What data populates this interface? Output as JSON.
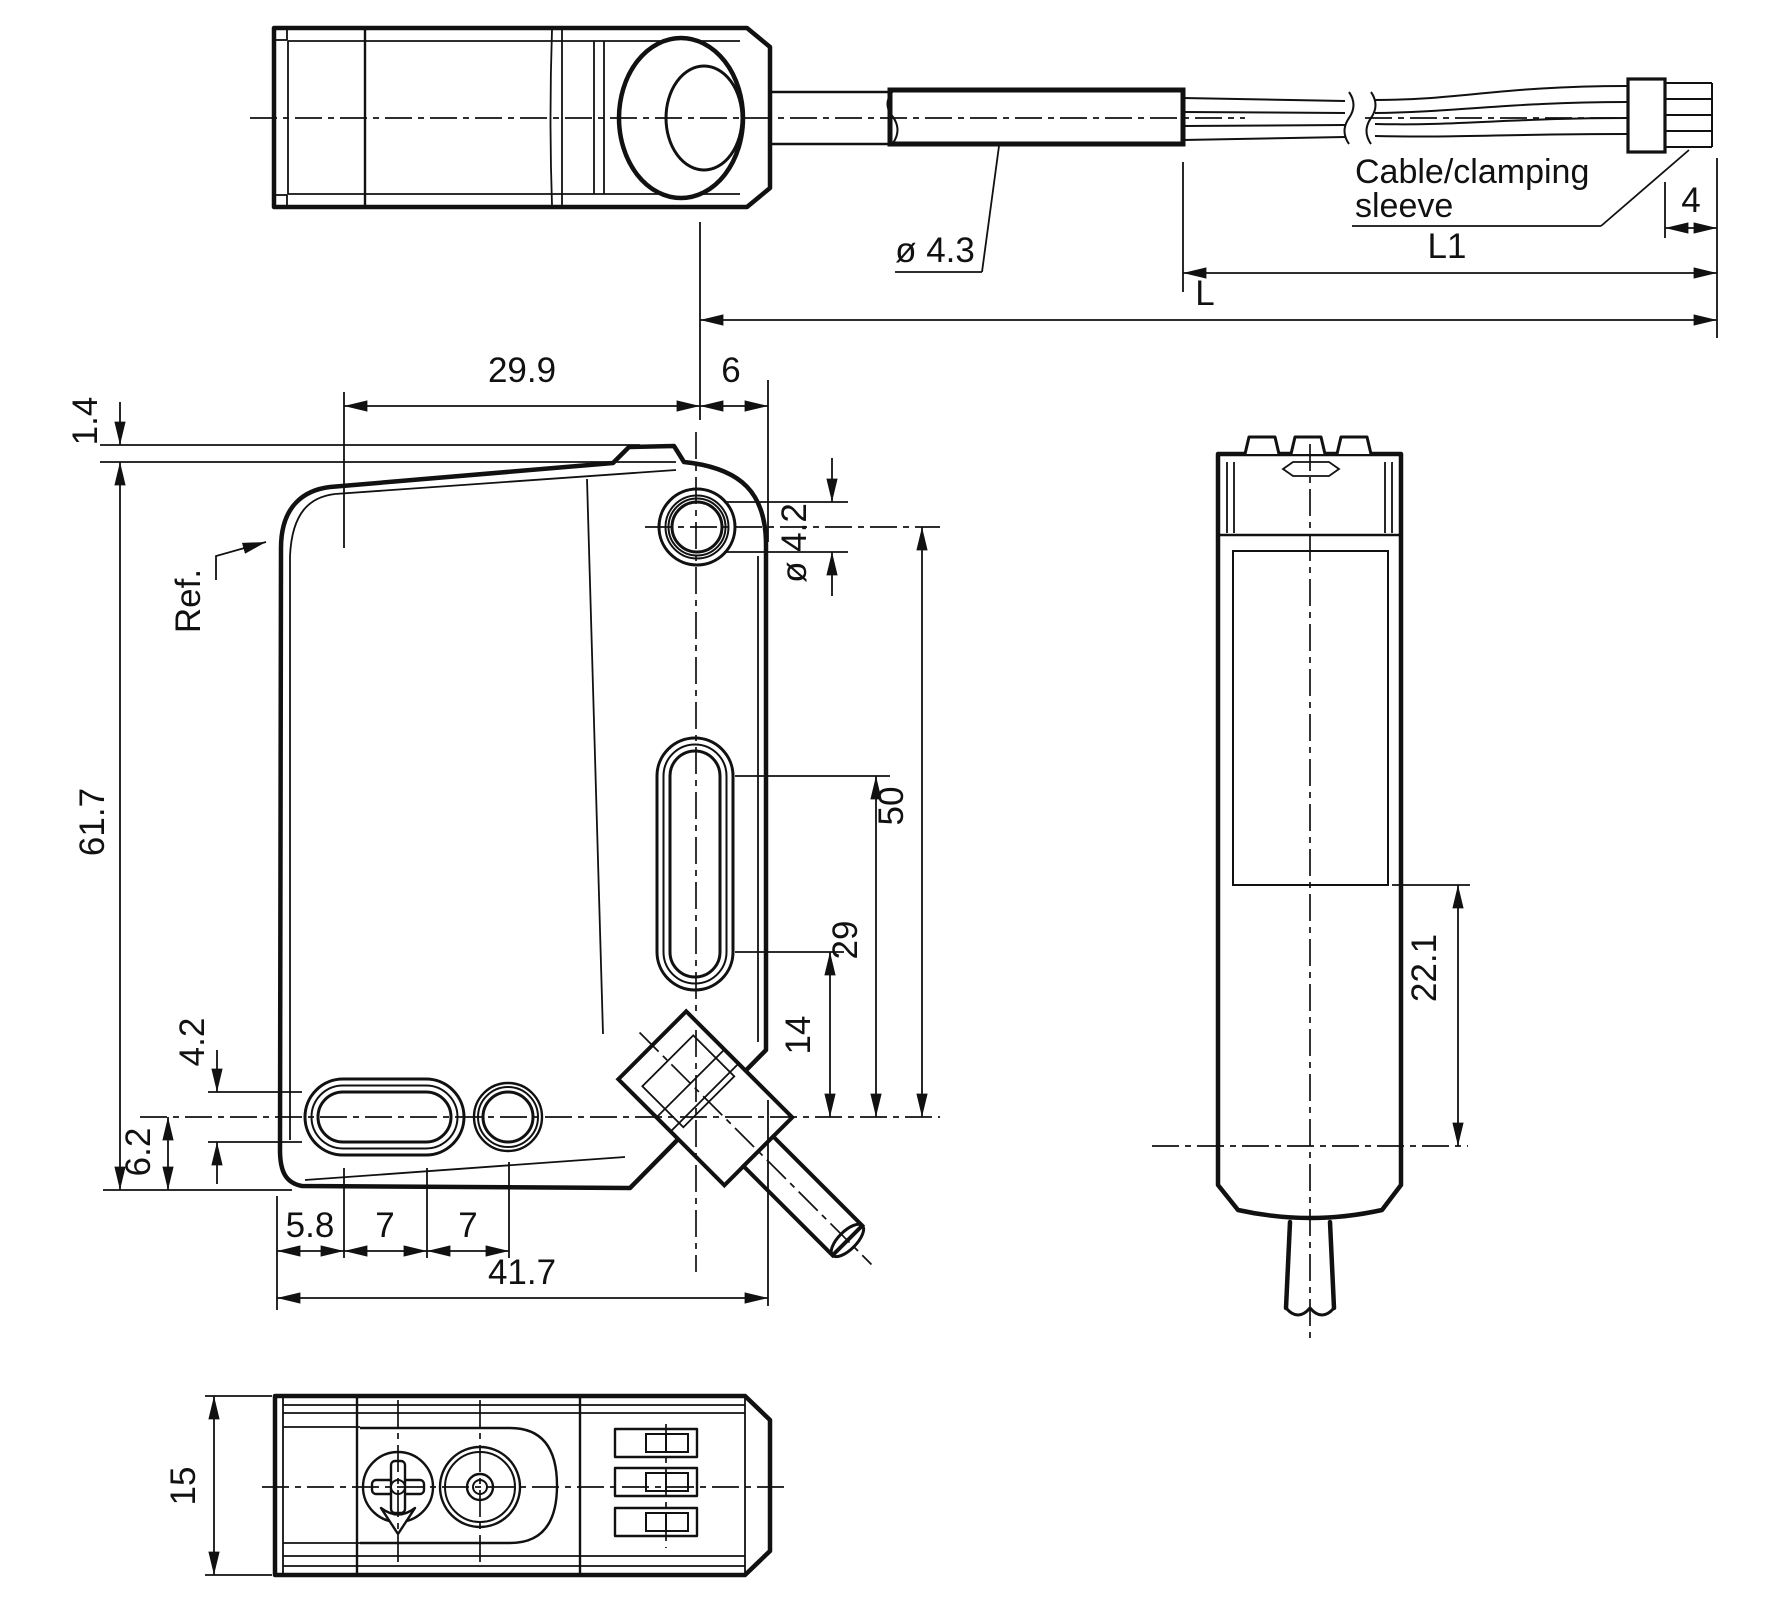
{
  "drawing": {
    "top_view": {
      "dim_29_9": "29.9",
      "dim_6": "6"
    },
    "cable_assembly": {
      "dim_cable_diameter": "ø 4.3",
      "note_line1": "Cable/clamping",
      "note_line2": "sleeve",
      "dim_sleeve_length": "4",
      "dim_l1": "L1",
      "dim_l": "L"
    },
    "front_view": {
      "dim_1_4": "1.4",
      "ref_label": "Ref.",
      "dim_61_7": "61.7",
      "dim_slot_height": "4.2",
      "dim_6_2": "6.2",
      "dim_5_8": "5.8",
      "dim_7a": "7",
      "dim_7b": "7",
      "dim_41_7": "41.7",
      "dim_hole_diameter": "ø 4.2",
      "dim_50": "50",
      "dim_29": "29",
      "dim_14": "14"
    },
    "side_view": {
      "dim_22_1": "22.1"
    },
    "bottom_view": {
      "dim_15": "15"
    }
  }
}
